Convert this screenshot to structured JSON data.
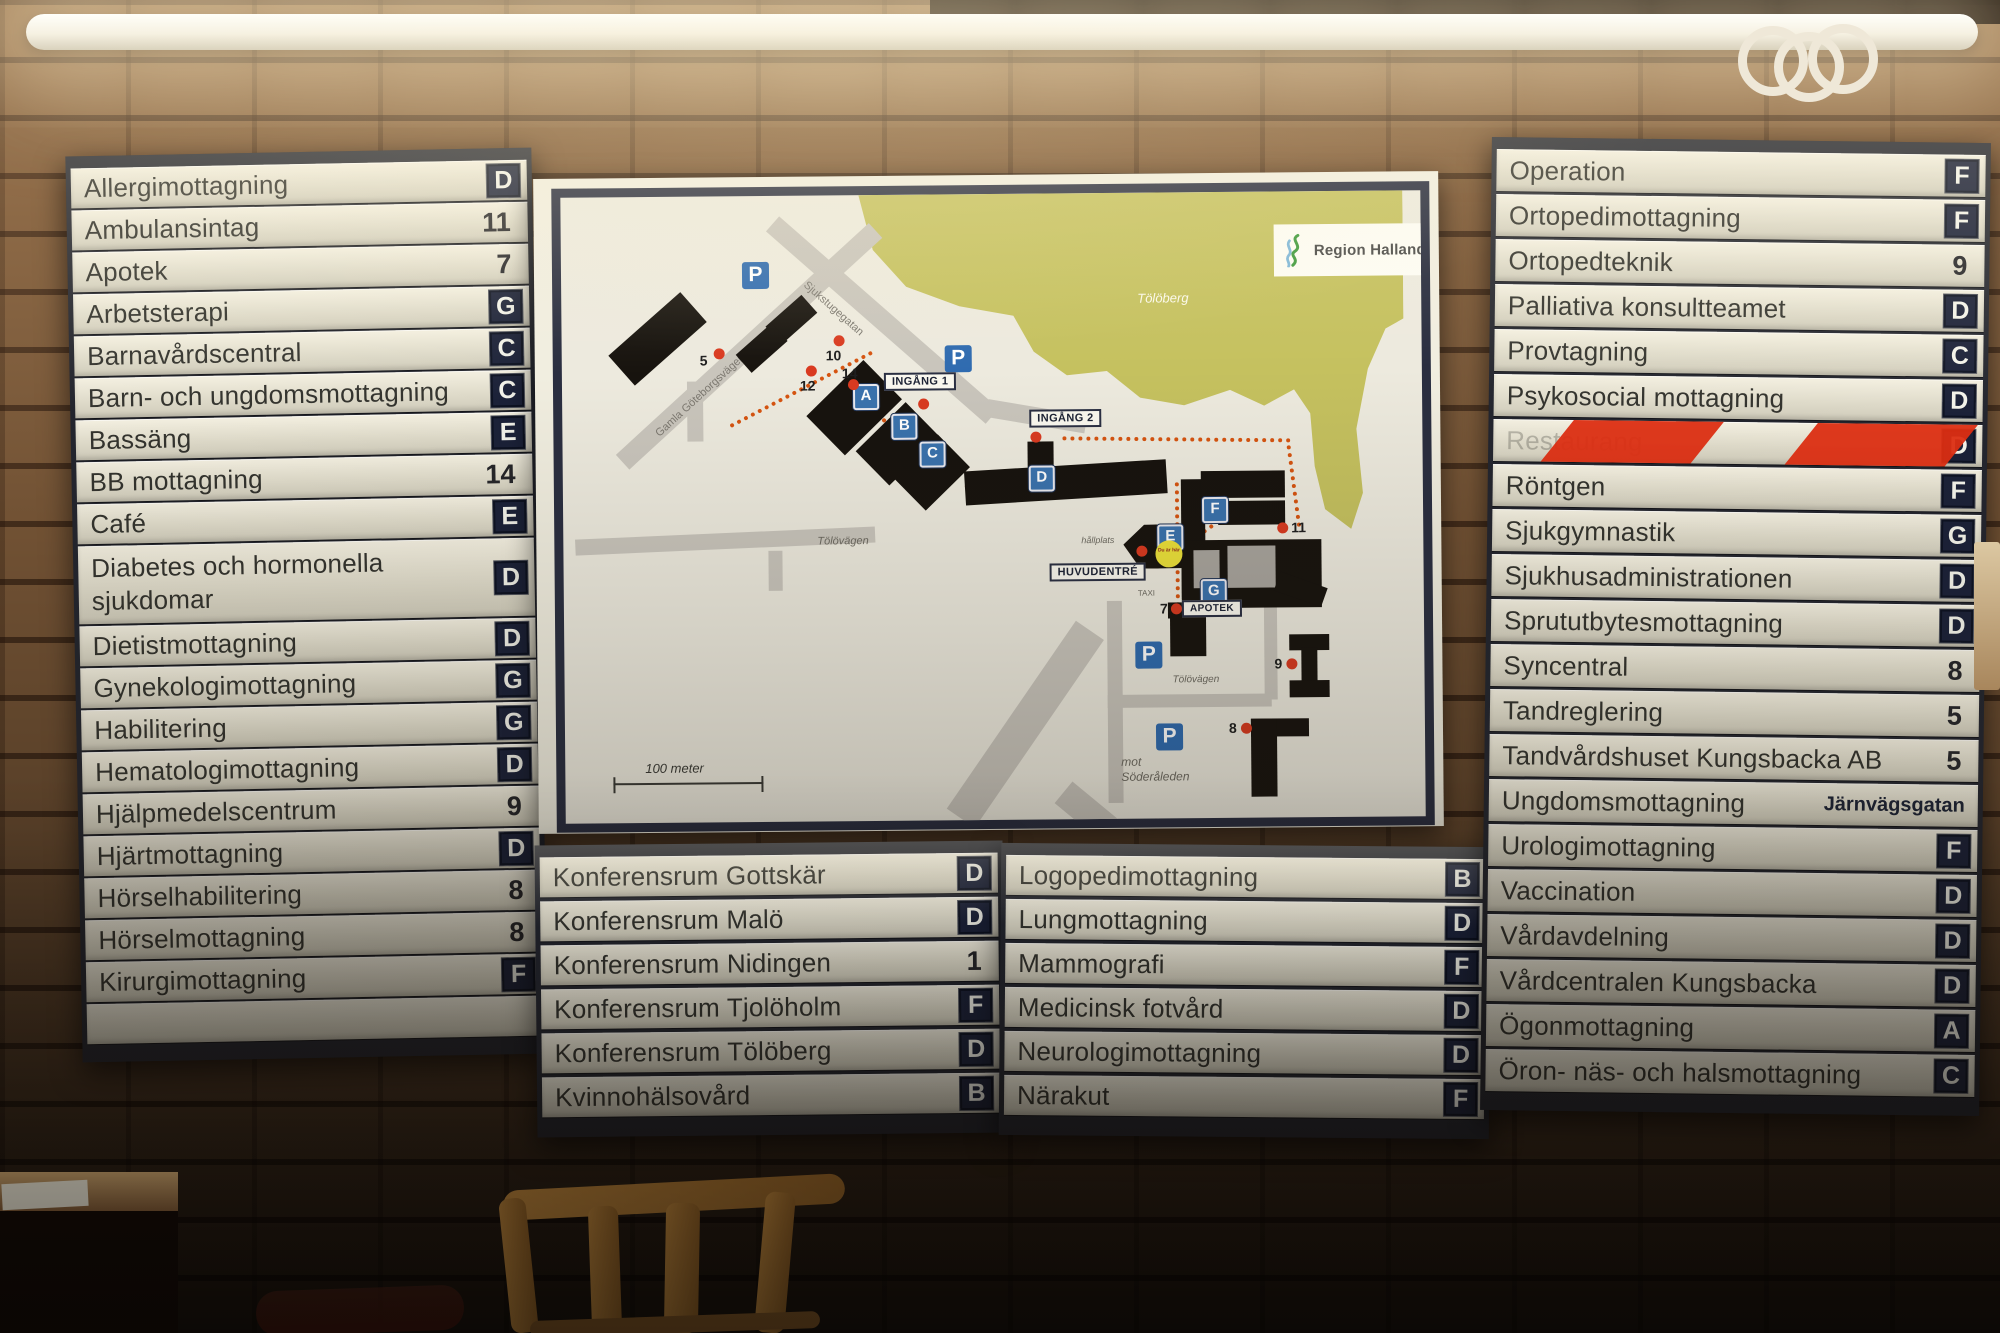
{
  "colors": {
    "badge_navy": "#1b2138",
    "slat_cream": "#eeeadb",
    "frame_dark": "#23252e",
    "map_zone_blue": "#3a72ad",
    "parking_blue": "#2f6bb0",
    "marker_red": "#d93a20",
    "hazard_red": "#dd2e12",
    "hill_green": "#c5c15f",
    "path_orange": "#d65410"
  },
  "board": {
    "left_panel": {
      "rows": [
        {
          "label": "Allergimottagning",
          "code": "D",
          "style": "badge"
        },
        {
          "label": "Ambulansintag",
          "code": "11",
          "style": "number"
        },
        {
          "label": "Apotek",
          "code": "7",
          "style": "number"
        },
        {
          "label": "Arbetsterapi",
          "code": "G",
          "style": "badge"
        },
        {
          "label": "Barnavårdscentral",
          "code": "C",
          "style": "badge"
        },
        {
          "label": "Barn- och ungdomsmottagning",
          "code": "C",
          "style": "badge"
        },
        {
          "label": "Bassäng",
          "code": "E",
          "style": "badge"
        },
        {
          "label": "BB mottagning",
          "code": "14",
          "style": "number"
        },
        {
          "label": "Café",
          "code": "E",
          "style": "badge"
        },
        {
          "label": "Diabetes och hormonella sjukdomar",
          "code": "D",
          "style": "badge",
          "tall": true
        },
        {
          "label": "Dietistmottagning",
          "code": "D",
          "style": "badge"
        },
        {
          "label": "Gynekologimottagning",
          "code": "G",
          "style": "badge"
        },
        {
          "label": "Habilitering",
          "code": "G",
          "style": "badge"
        },
        {
          "label": "Hematologimottagning",
          "code": "D",
          "style": "badge"
        },
        {
          "label": "Hjälpmedelscentrum",
          "code": "9",
          "style": "number"
        },
        {
          "label": "Hjärtmottagning",
          "code": "D",
          "style": "badge"
        },
        {
          "label": "Hörselhabilitering",
          "code": "8",
          "style": "number"
        },
        {
          "label": "Hörselmottagning",
          "code": "8",
          "style": "number"
        },
        {
          "label": "Kirurgimottagning",
          "code": "F",
          "style": "badge"
        },
        {
          "label": "",
          "code": "",
          "style": "empty"
        }
      ]
    },
    "bottom_left_panel": {
      "rows": [
        {
          "label": "Konferensrum Gottskär",
          "code": "D",
          "style": "badge"
        },
        {
          "label": "Konferensrum Malö",
          "code": "D",
          "style": "badge"
        },
        {
          "label": "Konferensrum Nidingen",
          "code": "1",
          "style": "number"
        },
        {
          "label": "Konferensrum Tjolöholm",
          "code": "F",
          "style": "badge"
        },
        {
          "label": "Konferensrum Tölöberg",
          "code": "D",
          "style": "badge"
        },
        {
          "label": "Kvinnohälsovård",
          "code": "B",
          "style": "badge"
        }
      ]
    },
    "bottom_right_panel": {
      "rows": [
        {
          "label": "Logopedimottagning",
          "code": "B",
          "style": "badge"
        },
        {
          "label": "Lungmottagning",
          "code": "D",
          "style": "badge"
        },
        {
          "label": "Mammografi",
          "code": "F",
          "style": "badge"
        },
        {
          "label": "Medicinsk fotvård",
          "code": "D",
          "style": "badge"
        },
        {
          "label": "Neurologimottagning",
          "code": "D",
          "style": "badge"
        },
        {
          "label": "Närakut",
          "code": "F",
          "style": "badge"
        }
      ]
    },
    "right_panel": {
      "rows": [
        {
          "label": "Operation",
          "code": "F",
          "style": "badge"
        },
        {
          "label": "Ortopedimottagning",
          "code": "F",
          "style": "badge"
        },
        {
          "label": "Ortopedteknik",
          "code": "9",
          "style": "number"
        },
        {
          "label": "Palliativa konsultteamet",
          "code": "D",
          "style": "badge"
        },
        {
          "label": "Provtagning",
          "code": "C",
          "style": "badge"
        },
        {
          "label": "Psykosocial mottagning",
          "code": "D",
          "style": "badge"
        },
        {
          "label": "Restaurang",
          "code": "D",
          "style": "taped"
        },
        {
          "label": "Röntgen",
          "code": "F",
          "style": "badge"
        },
        {
          "label": "Sjukgymnastik",
          "code": "G",
          "style": "badge"
        },
        {
          "label": "Sjukhusadministrationen",
          "code": "D",
          "style": "badge"
        },
        {
          "label": "Sprututbytesmottagning",
          "code": "D",
          "style": "badge"
        },
        {
          "label": "Syncentral",
          "code": "8",
          "style": "number"
        },
        {
          "label": "Tandreglering",
          "code": "5",
          "style": "number"
        },
        {
          "label": "Tandvårdshuset Kungsbacka AB",
          "code": "5",
          "style": "number"
        },
        {
          "label": "Ungdomsmottagning",
          "code": "Järnvägsgatan",
          "style": "text"
        },
        {
          "label": "Urologimottagning",
          "code": "F",
          "style": "badge"
        },
        {
          "label": "Vaccination",
          "code": "D",
          "style": "badge"
        },
        {
          "label": "Vårdavdelning",
          "code": "D",
          "style": "badge"
        },
        {
          "label": "Vårdcentralen Kungsbacka",
          "code": "D",
          "style": "badge"
        },
        {
          "label": "Ögonmottagning",
          "code": "A",
          "style": "badge"
        },
        {
          "label": "Öron- näs- och halsmottagning",
          "code": "C",
          "style": "badge"
        }
      ]
    }
  },
  "map": {
    "logo": "Region Halland",
    "hill": "Tölöberg",
    "roads": [
      "Gamla Göteborgsvägen",
      "Sjukstugegatan",
      "Tölövägen",
      "Tölövägen"
    ],
    "labels": {
      "ingang1": "INGÅNG 1",
      "ingang2": "INGÅNG 2",
      "huvudentre": "HUVUDENTRÉ",
      "apotek": "APOTEK",
      "hallplats": "hållplats",
      "taxi": "TAXI",
      "soderaleden": "mot Söderåleden",
      "scale": "100 meter",
      "you_are_here": "Du är här"
    },
    "zones": [
      "A",
      "B",
      "C",
      "D",
      "E",
      "F",
      "G"
    ],
    "dots": [
      "5",
      "10",
      "12",
      "14",
      "11",
      "7",
      "9",
      "8"
    ],
    "parking": "P"
  }
}
